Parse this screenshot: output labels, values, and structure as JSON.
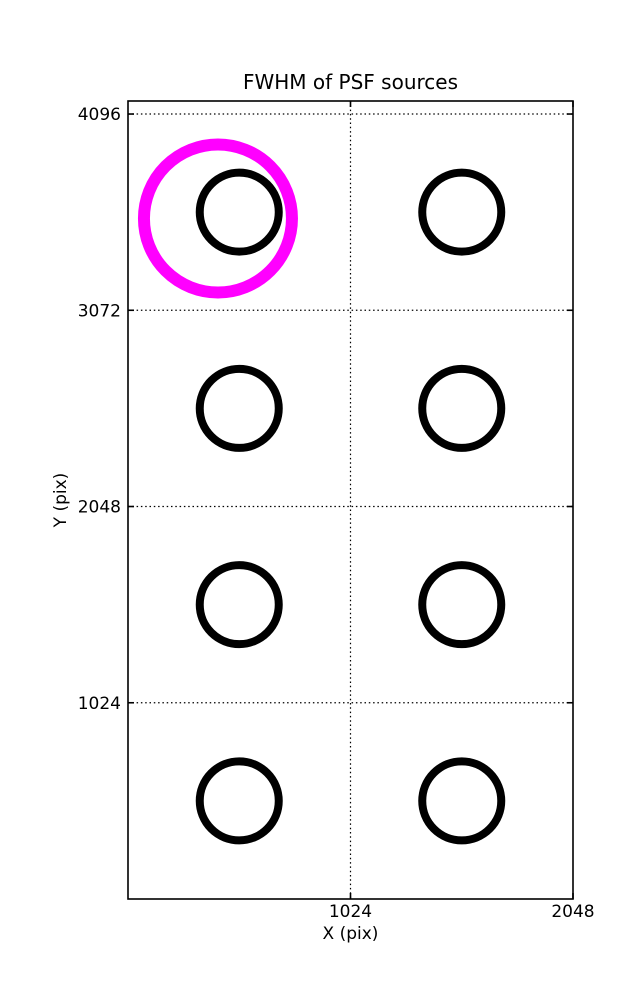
{
  "figure": {
    "background_color": "#ffffff",
    "width_px": 637,
    "height_px": 1000
  },
  "chart_data": {
    "type": "scatter",
    "title": "FWHM of PSF sources",
    "xlabel": "X (pix)",
    "ylabel": "Y (pix)",
    "xlim": [
      0,
      2048
    ],
    "ylim": [
      0,
      4164
    ],
    "xticks": [
      1024,
      2048
    ],
    "yticks": [
      1024,
      2048,
      3072,
      4096
    ],
    "grid": {
      "style": "dotted",
      "color": "#000000",
      "x_gridlines": [
        1024
      ],
      "y_gridlines": [
        1024,
        2048,
        3072,
        4096
      ]
    },
    "axes_color": "#000000",
    "tick_direction": "in",
    "legend": "none",
    "series": [
      {
        "name": "psf-sources",
        "marker": "open-circle",
        "color": "#000000",
        "marker_radius_px": 39.5,
        "stroke_width_px": 8,
        "points": [
          {
            "x": 512,
            "y": 3584
          },
          {
            "x": 1536,
            "y": 3584
          },
          {
            "x": 512,
            "y": 2560
          },
          {
            "x": 1536,
            "y": 2560
          },
          {
            "x": 512,
            "y": 1536
          },
          {
            "x": 1536,
            "y": 1536
          },
          {
            "x": 512,
            "y": 512
          },
          {
            "x": 1536,
            "y": 512
          }
        ]
      },
      {
        "name": "highlighted-source",
        "marker": "open-circle",
        "color": "#FF00FF",
        "marker_radius_px": 74,
        "stroke_width_px": 12,
        "points": [
          {
            "x": 414,
            "y": 3551
          }
        ]
      }
    ]
  }
}
